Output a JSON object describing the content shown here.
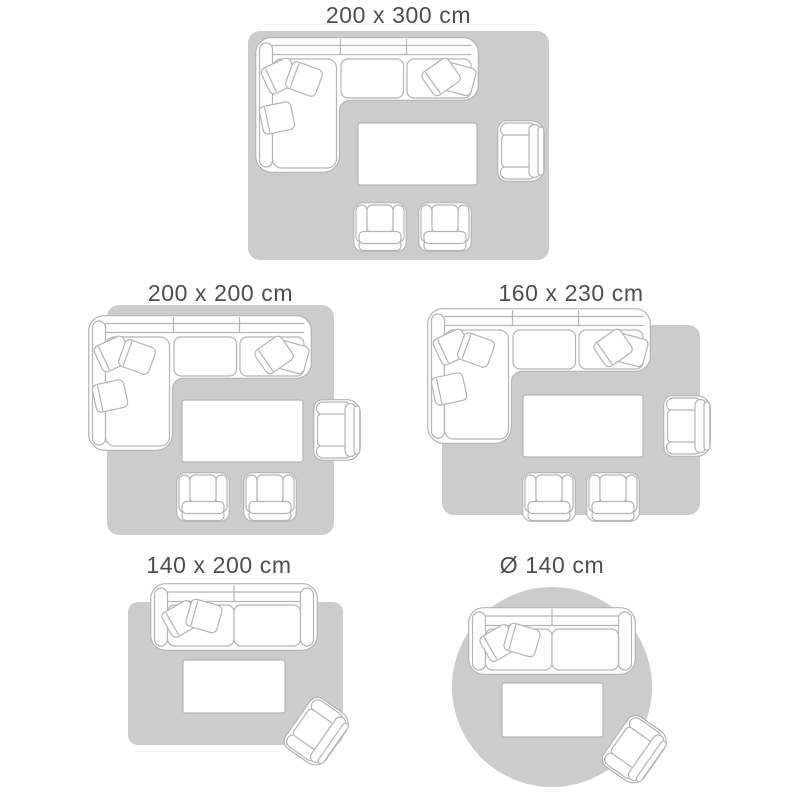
{
  "colors": {
    "background": "#ffffff",
    "rug": "#cccccc",
    "furniture_fill": "#ffffff",
    "furniture_outline": "#b4b4b4",
    "label_text": "#4d4d4d"
  },
  "diagrams": [
    {
      "label": "200 x 300 cm",
      "rug_shape": "rectangle",
      "furniture": [
        "corner sofa",
        "coffee table",
        "armchair",
        "chair",
        "chair"
      ]
    },
    {
      "label": "200 x 200 cm",
      "rug_shape": "square",
      "furniture": [
        "corner sofa",
        "coffee table",
        "armchair",
        "chair",
        "chair"
      ]
    },
    {
      "label": "160 x 230 cm",
      "rug_shape": "rectangle",
      "furniture": [
        "corner sofa",
        "coffee table",
        "armchair",
        "chair",
        "chair"
      ]
    },
    {
      "label": "140 x 200 cm",
      "rug_shape": "rectangle",
      "furniture": [
        "two-seat sofa",
        "coffee table",
        "armchair"
      ]
    },
    {
      "label": "Ø 140 cm",
      "rug_shape": "circle",
      "furniture": [
        "two-seat sofa",
        "coffee table",
        "armchair"
      ]
    }
  ]
}
